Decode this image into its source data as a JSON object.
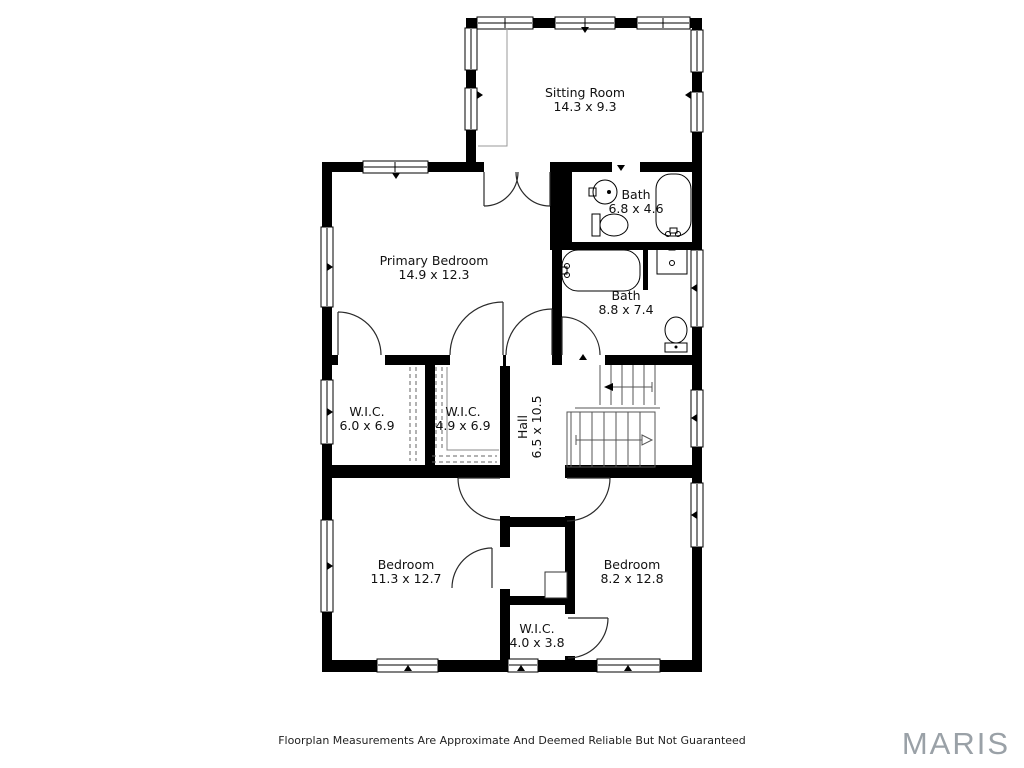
{
  "rooms": {
    "sitting_room": {
      "name": "Sitting Room",
      "dims": "14.3 x 9.3"
    },
    "primary_bedroom": {
      "name": "Primary Bedroom",
      "dims": "14.9 x 12.3"
    },
    "bath_upper": {
      "name": "Bath",
      "dims": "6.8 x 4.6"
    },
    "bath_lower": {
      "name": "Bath",
      "dims": "8.8 x 7.4"
    },
    "wic_left": {
      "name": "W.I.C.",
      "dims": "6.0 x 6.9"
    },
    "wic_center": {
      "name": "W.I.C.",
      "dims": "4.9 x 6.9"
    },
    "hall": {
      "name": "Hall",
      "dims": "6.5 x 10.5"
    },
    "bedroom_left": {
      "name": "Bedroom",
      "dims": "11.3 x 12.7"
    },
    "bedroom_right": {
      "name": "Bedroom",
      "dims": "8.2 x 12.8"
    },
    "wic_bottom": {
      "name": "W.I.C.",
      "dims": "4.0 x 3.8"
    }
  },
  "footer_text": "Floorplan Measurements Are Approximate And Deemed Reliable But Not Guaranteed",
  "watermark": "MARIS",
  "colors": {
    "wall": "#000000",
    "door_line": "#2a2a2a",
    "stair_line": "#555555",
    "label_text": "#111111",
    "watermark_gray": "#9aa1a7"
  }
}
